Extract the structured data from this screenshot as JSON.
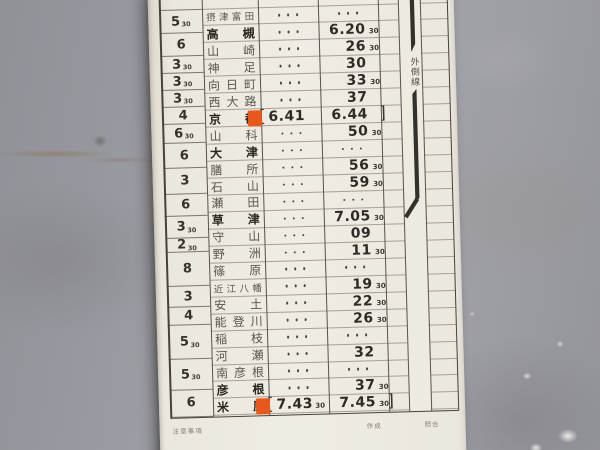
{
  "colors": {
    "card_bg": "#edeae1",
    "wall_gray": "#9b9ca1",
    "accent_orange": "#e8571c",
    "route_line": "#34312c"
  },
  "card": {
    "track_label": "外側線",
    "footer": {
      "notes": "注意事項",
      "created": "作成",
      "checked": "照合"
    },
    "run_time_cells": [
      {
        "h": 18.5,
        "v": "",
        "s": ""
      },
      {
        "h": 23,
        "v": "5",
        "s": "30"
      },
      {
        "h": 23,
        "v": "6",
        "s": ""
      },
      {
        "h": 17,
        "v": "3",
        "s": "30"
      },
      {
        "h": 17,
        "v": "3",
        "s": "30"
      },
      {
        "h": 17,
        "v": "3",
        "s": "30"
      },
      {
        "h": 17,
        "v": "4",
        "s": ""
      },
      {
        "h": 19,
        "v": "6",
        "s": "30"
      },
      {
        "h": 25,
        "v": "6",
        "s": ""
      },
      {
        "h": 26,
        "v": "3",
        "s": ""
      },
      {
        "h": 22,
        "v": "6",
        "s": ""
      },
      {
        "h": 22,
        "v": "3",
        "s": "30"
      },
      {
        "h": 14,
        "v": "2",
        "s": "30"
      },
      {
        "h": 34,
        "v": "8",
        "s": ""
      },
      {
        "h": 21,
        "v": "3",
        "s": ""
      },
      {
        "h": 18,
        "v": "4",
        "s": ""
      },
      {
        "h": 34,
        "v": "5",
        "s": "30"
      },
      {
        "h": 31,
        "v": "5",
        "s": "30"
      },
      {
        "h": 26.5,
        "v": "6",
        "s": ""
      }
    ],
    "rows": [
      {
        "name": "",
        "partial": true,
        "arr": {
          "kind": "none"
        },
        "dep": {
          "kind": "time",
          "t": "15",
          "s": ""
        }
      },
      {
        "name": "摂津富田",
        "bold": false,
        "arr": {
          "kind": "dots"
        },
        "dep": {
          "kind": "dots"
        }
      },
      {
        "name": "高槻",
        "bold": true,
        "arr": {
          "kind": "dots"
        },
        "dep": {
          "kind": "time",
          "t": "6.20",
          "s": "30"
        }
      },
      {
        "name": "山崎",
        "bold": false,
        "arr": {
          "kind": "dots"
        },
        "dep": {
          "kind": "time",
          "t": "26",
          "s": "30"
        }
      },
      {
        "name": "神足",
        "bold": false,
        "arr": {
          "kind": "dots"
        },
        "dep": {
          "kind": "time",
          "t": "30",
          "s": ""
        }
      },
      {
        "name": "向日町",
        "bold": false,
        "arr": {
          "kind": "dots"
        },
        "dep": {
          "kind": "time",
          "t": "33",
          "s": "30"
        }
      },
      {
        "name": "西大路",
        "bold": false,
        "arr": {
          "kind": "dots"
        },
        "dep": {
          "kind": "time",
          "t": "37",
          "s": ""
        }
      },
      {
        "name": "京都",
        "bold": true,
        "orange": true,
        "arr": {
          "kind": "time",
          "t": "6.41",
          "s": "",
          "open": true
        },
        "dep": {
          "kind": "time",
          "t": "6.44",
          "s": "",
          "close": true
        }
      },
      {
        "name": "山科",
        "bold": false,
        "arr": {
          "kind": "dots"
        },
        "dep": {
          "kind": "time",
          "t": "50",
          "s": "30"
        }
      },
      {
        "name": "大津",
        "bold": true,
        "arr": {
          "kind": "dots"
        },
        "dep": {
          "kind": "dots"
        }
      },
      {
        "name": "膳所",
        "bold": false,
        "arr": {
          "kind": "dots"
        },
        "dep": {
          "kind": "time",
          "t": "56",
          "s": "30"
        }
      },
      {
        "name": "石山",
        "bold": false,
        "arr": {
          "kind": "dots"
        },
        "dep": {
          "kind": "time",
          "t": "59",
          "s": "30"
        }
      },
      {
        "name": "瀬田",
        "bold": false,
        "arr": {
          "kind": "dots"
        },
        "dep": {
          "kind": "dots"
        }
      },
      {
        "name": "草津",
        "bold": true,
        "arr": {
          "kind": "dots"
        },
        "dep": {
          "kind": "time",
          "t": "7.05",
          "s": "30"
        }
      },
      {
        "name": "守山",
        "bold": false,
        "arr": {
          "kind": "dots"
        },
        "dep": {
          "kind": "time",
          "t": "09",
          "s": ""
        }
      },
      {
        "name": "野洲",
        "bold": false,
        "arr": {
          "kind": "dots"
        },
        "dep": {
          "kind": "time",
          "t": "11",
          "s": "30"
        }
      },
      {
        "name": "篠原",
        "bold": false,
        "arr": {
          "kind": "dots"
        },
        "dep": {
          "kind": "dots"
        }
      },
      {
        "name": "近江八幡",
        "bold": false,
        "arr": {
          "kind": "dots"
        },
        "dep": {
          "kind": "time",
          "t": "19",
          "s": "30"
        }
      },
      {
        "name": "安土",
        "bold": false,
        "arr": {
          "kind": "dots"
        },
        "dep": {
          "kind": "time",
          "t": "22",
          "s": "30"
        }
      },
      {
        "name": "能登川",
        "bold": false,
        "arr": {
          "kind": "dots"
        },
        "dep": {
          "kind": "time",
          "t": "26",
          "s": "30"
        }
      },
      {
        "name": "稲枝",
        "bold": false,
        "arr": {
          "kind": "dots"
        },
        "dep": {
          "kind": "dots"
        }
      },
      {
        "name": "河瀬",
        "bold": false,
        "arr": {
          "kind": "dots"
        },
        "dep": {
          "kind": "time",
          "t": "32",
          "s": ""
        }
      },
      {
        "name": "南彦根",
        "bold": false,
        "arr": {
          "kind": "dots"
        },
        "dep": {
          "kind": "dots"
        }
      },
      {
        "name": "彦根",
        "bold": true,
        "arr": {
          "kind": "dots"
        },
        "dep": {
          "kind": "time",
          "t": "37",
          "s": "30"
        }
      },
      {
        "name": "米原",
        "bold": true,
        "orange": true,
        "arr": {
          "kind": "time",
          "t": "7.43",
          "s": "30",
          "open": true
        },
        "dep": {
          "kind": "time",
          "t": "7.45",
          "s": "30",
          "close": true
        }
      }
    ]
  }
}
